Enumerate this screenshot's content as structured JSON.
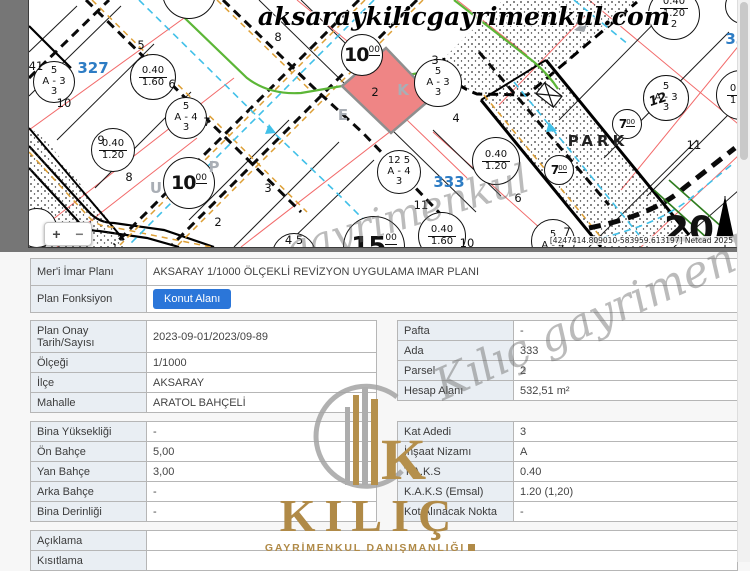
{
  "map": {
    "domain_watermark": "aksaraykilicgayrimenkul.com",
    "script_watermark_1": "gayrimenkul",
    "script_watermark_2": "Kılıç gayrimenkul",
    "netcad_note": "[4247414.809010-583959.613197] Netcad 2025",
    "zoom_in_label": "+",
    "zoom_out_label": "−",
    "selected_parcel": "2",
    "circles": [
      {
        "x": 25,
        "y": 82,
        "r": 21,
        "lines": [
          "5",
          "A - 3",
          "3"
        ]
      },
      {
        "x": 124,
        "y": 77,
        "r": 23,
        "frac": [
          "0.40",
          "1.60"
        ]
      },
      {
        "x": 157,
        "y": 118,
        "r": 21,
        "lines": [
          "5",
          "A - 4",
          "3"
        ]
      },
      {
        "x": 84,
        "y": 150,
        "r": 22,
        "frac": [
          "0.40",
          "1.20"
        ]
      },
      {
        "x": 160,
        "y": 183,
        "r": 26,
        "road": "10"
      },
      {
        "x": 333,
        "y": 55,
        "r": 21,
        "road": "10"
      },
      {
        "x": 409,
        "y": 83,
        "r": 24,
        "lines": [
          "5",
          "A - 3",
          "3"
        ]
      },
      {
        "x": 370,
        "y": 172,
        "r": 22,
        "lines": [
          "12 5",
          "A - 4",
          "3"
        ]
      },
      {
        "x": 467,
        "y": 161,
        "r": 24,
        "frac": [
          "0.40",
          "1.20"
        ]
      },
      {
        "x": 413,
        "y": 236,
        "r": 24,
        "frac": [
          "0.40",
          "1.60"
        ]
      },
      {
        "x": 345,
        "y": 247,
        "r": 31,
        "road": "15"
      },
      {
        "x": 265,
        "y": 255,
        "r": 22,
        "lines": []
      },
      {
        "x": 530,
        "y": 170,
        "r": 15,
        "road": "7",
        "small": true
      },
      {
        "x": 598,
        "y": 124,
        "r": 15,
        "road": "7",
        "small": true
      },
      {
        "x": 637,
        "y": 98,
        "r": 23,
        "lines": [
          "5",
          "A - 3",
          "3"
        ]
      },
      {
        "x": 645,
        "y": 14,
        "r": 26,
        "frac": [
          "0.40",
          "1.20"
        ],
        "extra": "2"
      },
      {
        "x": 712,
        "y": 95,
        "r": 25,
        "frac": [
          "0.40",
          "1.60"
        ]
      },
      {
        "x": 524,
        "y": 241,
        "r": 22,
        "lines": [
          "5",
          "A - 4"
        ]
      },
      {
        "x": 160,
        "y": -8,
        "r": 27,
        "lines": []
      },
      {
        "x": 8,
        "y": 228,
        "r": 20,
        "lines": []
      },
      {
        "x": 714,
        "y": 6,
        "r": 18,
        "lines": []
      }
    ],
    "labels": [
      {
        "t": "327",
        "c": "ada",
        "x": 64,
        "y": 68
      },
      {
        "t": "333",
        "c": "ada",
        "x": 420,
        "y": 182
      },
      {
        "t": "334",
        "c": "ada",
        "x": 712,
        "y": 39
      },
      {
        "t": "PARK",
        "c": "park",
        "x": 569,
        "y": 141
      },
      {
        "t": "8",
        "c": "parcel",
        "x": 249,
        "y": 37
      },
      {
        "t": "8",
        "c": "parcel",
        "x": 100,
        "y": 177
      },
      {
        "t": "2",
        "c": "parcel",
        "x": 346,
        "y": 92
      },
      {
        "t": "4",
        "c": "parcel",
        "x": 427,
        "y": 118
      },
      {
        "t": "2",
        "c": "parcel",
        "x": 189,
        "y": 222
      },
      {
        "t": "3",
        "c": "parcel",
        "x": 239,
        "y": 188
      },
      {
        "t": "11",
        "c": "parcel",
        "x": 392,
        "y": 205
      },
      {
        "t": "11",
        "c": "parcel",
        "x": 665,
        "y": 145
      },
      {
        "t": "6",
        "c": "parcel",
        "x": 489,
        "y": 198
      },
      {
        "t": "10",
        "c": "parcel",
        "x": 35,
        "y": 103
      },
      {
        "t": "7",
        "c": "parcel",
        "x": 178,
        "y": 122
      },
      {
        "t": "41",
        "c": "parcel",
        "x": 7,
        "y": 66
      },
      {
        "t": "5",
        "c": "parcel",
        "x": 112,
        "y": 45
      },
      {
        "t": "6",
        "c": "parcel",
        "x": 143,
        "y": 84
      },
      {
        "t": "3",
        "c": "parcel",
        "x": 406,
        "y": 60
      },
      {
        "t": "9",
        "c": "parcel",
        "x": 72,
        "y": 140
      },
      {
        "t": "7",
        "c": "parcel",
        "x": 538,
        "y": 232
      },
      {
        "t": "10",
        "c": "parcel",
        "x": 438,
        "y": 243
      },
      {
        "t": "4 5",
        "c": "parcel",
        "x": 265,
        "y": 240
      },
      {
        "t": "12",
        "c": "over",
        "x": 629,
        "y": 100
      },
      {
        "t": "20",
        "c": "big",
        "x": 660,
        "y": 230
      },
      {
        "t": "E",
        "c": "street",
        "x": 314,
        "y": 115
      },
      {
        "t": "K",
        "c": "street",
        "x": 374,
        "y": 90
      },
      {
        "t": "U",
        "c": "street",
        "x": 127,
        "y": 188
      },
      {
        "t": "P",
        "c": "street",
        "x": 185,
        "y": 167
      }
    ]
  },
  "logo": {
    "name": "KILIÇ",
    "subtitle": "GAYRİMENKUL DANIŞMANLIĞI"
  },
  "tables": {
    "plan": {
      "rows": [
        {
          "label": "Mer'i İmar Planı",
          "value": "AKSARAY 1/1000 ÖLÇEKLİ REVİZYON UYGULAMA IMAR PLANI"
        },
        {
          "label": "Plan Fonksiyon",
          "value": "Konut Alanı"
        }
      ]
    },
    "onay": {
      "rows": [
        {
          "label": "Plan Onay Tarih/Sayısı",
          "value": "2023-09-01/2023/09-89"
        },
        {
          "label": "Ölçeği",
          "value": "1/1000"
        },
        {
          "label": "İlçe",
          "value": "AKSARAY"
        },
        {
          "label": "Mahalle",
          "value": "ARATOL BAHÇELİ"
        }
      ]
    },
    "parsel": {
      "rows": [
        {
          "label": "Pafta",
          "value": "-"
        },
        {
          "label": "Ada",
          "value": "333"
        },
        {
          "label": "Parsel",
          "value": "2"
        },
        {
          "label": "Hesap Alanı",
          "value": "532,51 m²"
        }
      ]
    },
    "yapi_left": {
      "rows": [
        {
          "label": "Bina Yüksekliği",
          "value": "-"
        },
        {
          "label": "Ön Bahçe",
          "value": "5,00"
        },
        {
          "label": "Yan Bahçe",
          "value": "3,00"
        },
        {
          "label": "Arka Bahçe",
          "value": "-"
        },
        {
          "label": "Bina Derinliği",
          "value": "-"
        }
      ]
    },
    "yapi_right": {
      "rows": [
        {
          "label": "Kat Adedi",
          "value": "3"
        },
        {
          "label": "İnşaat Nizamı",
          "value": "A"
        },
        {
          "label": "T.A.K.S",
          "value": "0.40"
        },
        {
          "label": "K.A.K.S (Emsal)",
          "value": "1.20 (1,20)"
        },
        {
          "label": "Kot Alınacak Nokta",
          "value": "-"
        }
      ]
    },
    "notes": {
      "rows": [
        {
          "label": "Açıklama",
          "value": ""
        },
        {
          "label": "Kısıtlama",
          "value": ""
        }
      ]
    }
  }
}
